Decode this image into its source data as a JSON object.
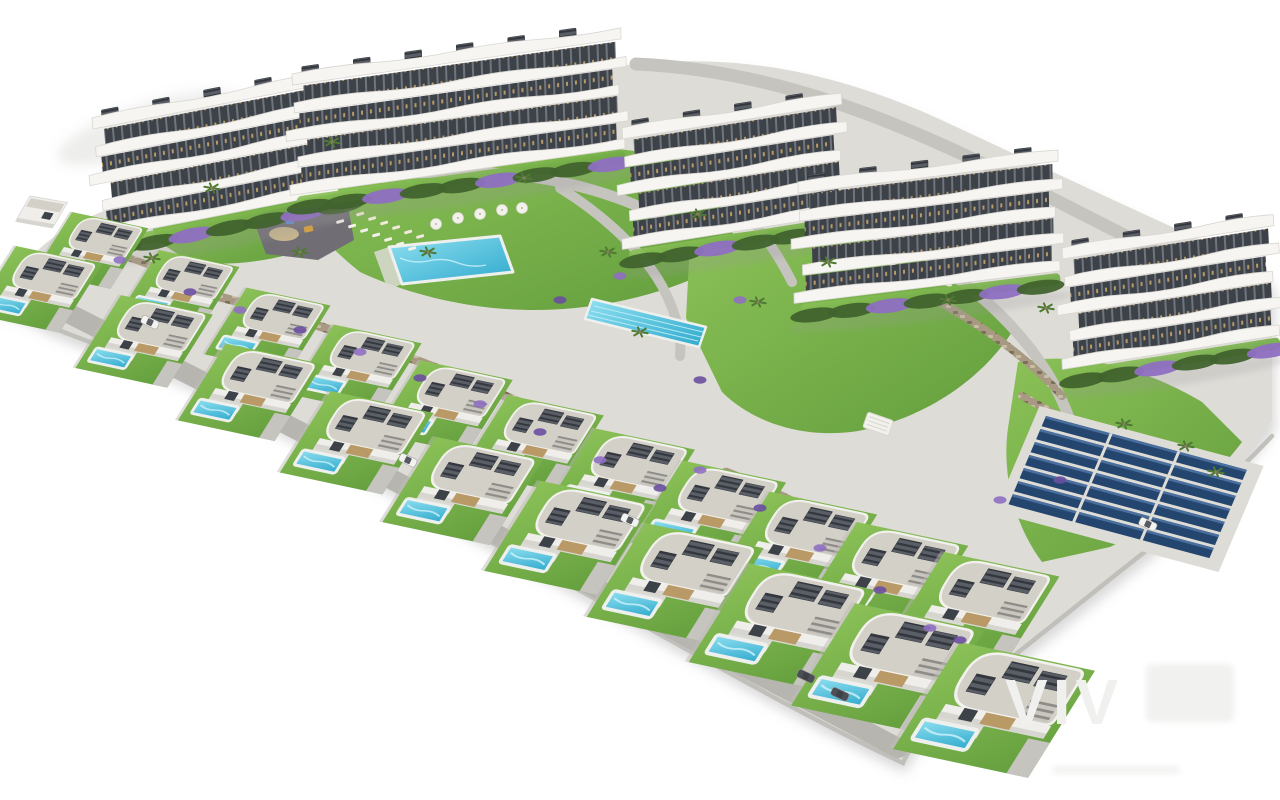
{
  "meta": {
    "type": "architectural-aerial-render",
    "description": "Aerial 3D render of a hillside residential development: five white apartment blocks with curved balconies at the top, two diagonal rows of white villas with private pools below, communal amenities in between, on a plain white background"
  },
  "watermark": {
    "text": "VIV"
  },
  "counts": {
    "apartment_buildings": 5,
    "floors_per_building": 4,
    "villas_upper_row": 11,
    "villas_lower_row": 10,
    "communal_pools": 2,
    "solar_panel_rows": 7,
    "playgrounds": 1,
    "cars": 6,
    "palm_trees": 16
  },
  "features": [
    "apartment blocks with curved white balconies",
    "roof terraces with pergolas",
    "villas with private pools and louvered roof decks",
    "communal swimming pool with sun loungers and parasols",
    "lap pool",
    "children's playground",
    "solar panel array",
    "stone retaining walls with purple flowering shrubs",
    "palm trees and lawns",
    "access road with parked cars"
  ],
  "palette": {
    "bg": "#ffffff",
    "plate": "#dedcd7",
    "plate_side": "#bdbbb6",
    "shadow": "#9a9998",
    "lawn_light": "#8bc157",
    "lawn_dark": "#639e3d",
    "hedge": "#41632e",
    "palm": "#4e7a33",
    "trunk": "#8a7a5e",
    "shrub": "#8f6fc2",
    "shrub_dark": "#6a4fa0",
    "pool_light": "#8fe0f0",
    "pool_deep": "#2fa9cd",
    "pool_rim": "#eef0ee",
    "stone": "#a89a82",
    "stone_dark": "#7c6f5a",
    "stone_hi": "#c9bda6",
    "asphalt": "#716d75",
    "path": "#c6c4bf",
    "road": "#b7b5b0",
    "slab_white": "#f6f5f2",
    "slab_edge": "#d9d7d2",
    "roof": "#d3d0c8",
    "roof_edge": "#f2f1ed",
    "louver": "#5a5e66",
    "louver_slat": "#34383e",
    "window_dark": "#3d4249",
    "window_mid": "#70757d",
    "wood": "#b99a66",
    "wall_white": "#efeeea",
    "wall_shade": "#d7d5d0",
    "terrace": "#dcdad5",
    "solar": "#24466e",
    "solar_hi": "#4a6f9e",
    "sand": "#cbb98f",
    "umbrella": "#f2f1ea",
    "lounger": "#f0ead9",
    "car_white": "#f2f2f0",
    "car_dark": "#4b4f55",
    "watermark": "#f0f0ef",
    "digger": "#d9a13c"
  }
}
